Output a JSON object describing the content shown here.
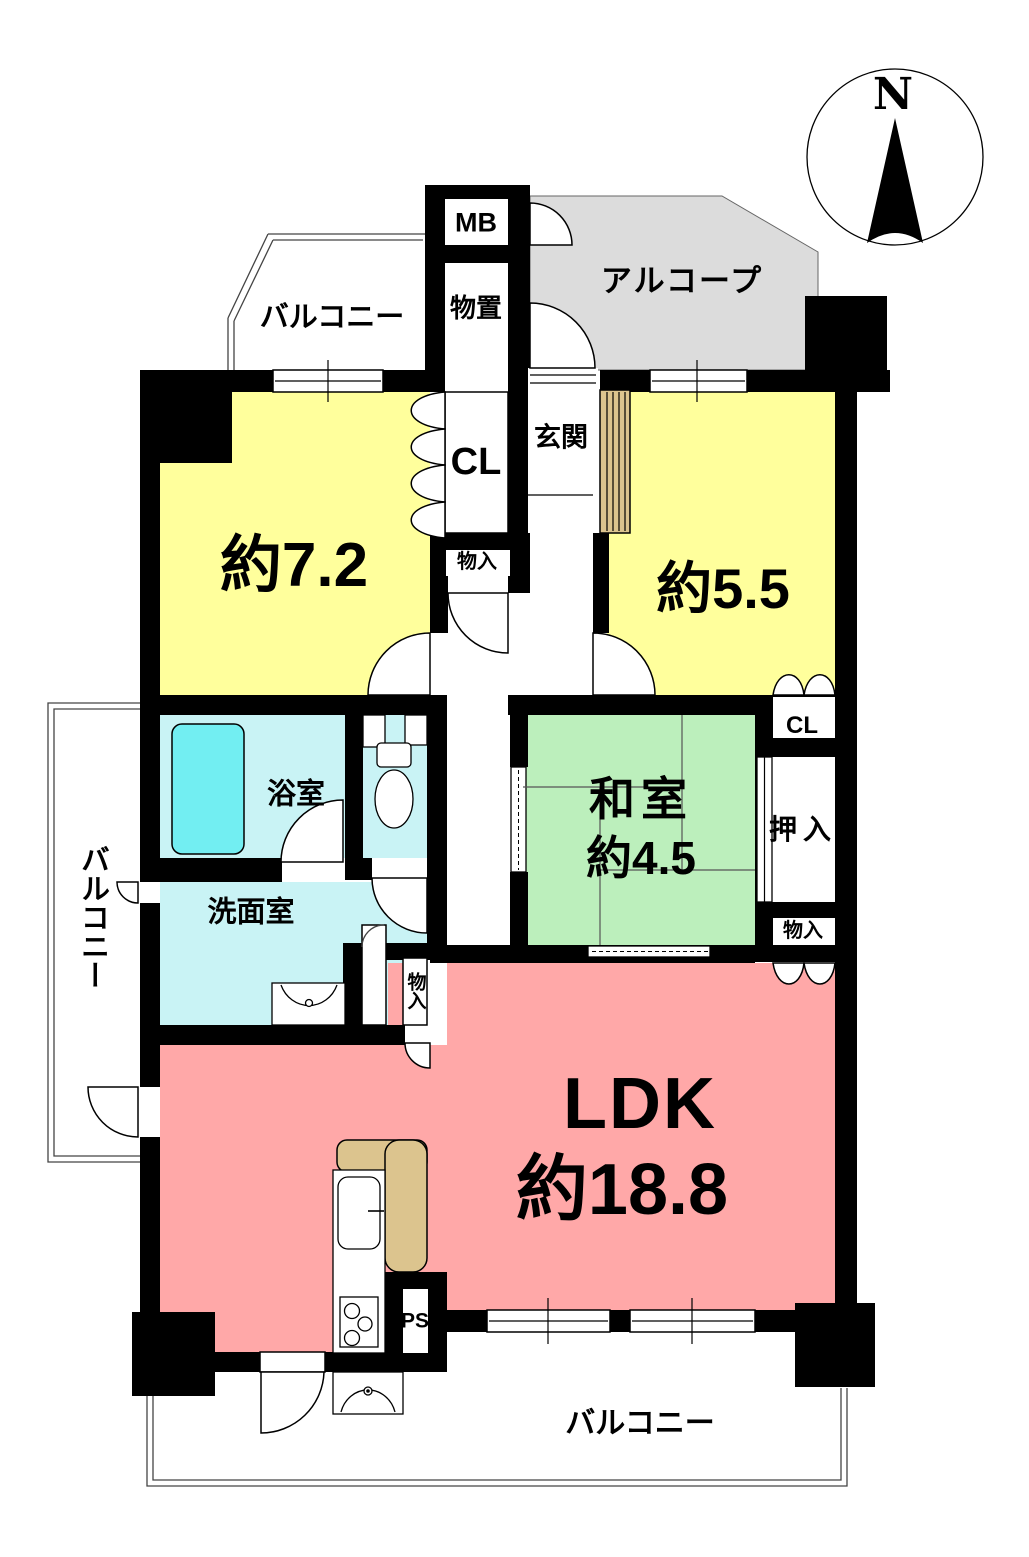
{
  "title": "マンション間取り図 (3LDK floor plan)",
  "compass": {
    "north_label": "N"
  },
  "labels": {
    "balcony_top": "バルコニー",
    "mb": "MB",
    "storage_top": "物置",
    "alcove": "アルコープ",
    "entrance": "玄関",
    "closet_top": "CL",
    "room_7_2": "約7.2",
    "storage_in_top": "物入",
    "room_5_5": "約5.5",
    "bathroom": "浴室",
    "washitsu": "和室",
    "washitsu_size": "約4.5",
    "closet_right": "CL",
    "oshiire": "押入",
    "balcony_left": "バルコニー",
    "washroom": "洗面室",
    "storage_in_right": "物入",
    "storage_in_ldk": "物入",
    "ldk": "LDK",
    "ldk_size": "約18.8",
    "ps": "PS",
    "balcony_bottom": "バルコニー"
  },
  "colors": {
    "wall": "#000000",
    "bedroom_yellow": "#FFFF9C",
    "ldk_pink": "#FFA8A8",
    "tatami_green": "#BCEFBC",
    "wet_area_cyan": "#C9F3F5",
    "bathtub_cyan": "#72EEF2",
    "alcove_gray": "#DCDCDC",
    "wood_tan": "#DCC48E"
  }
}
